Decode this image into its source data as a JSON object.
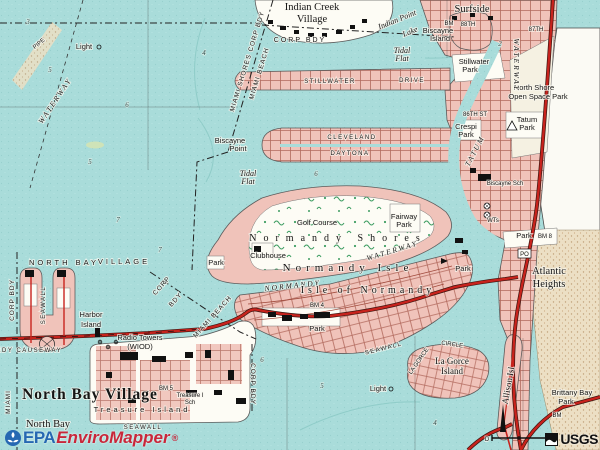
{
  "branding": {
    "epa": "EPA",
    "product": "EnviroMapper",
    "reg": "®",
    "usgs": "USGS"
  },
  "colors": {
    "water": "#a9dcda",
    "urban_pink": "#f0c3ba",
    "street_line": "#b26a5e",
    "major_road_red": "#c8231d",
    "land_white": "#fdfcf5",
    "beach_sand": "#ecdfc4",
    "golf_green": "#3f9e63",
    "epa_blue": "#2668b2",
    "mapper_red": "#c8273a"
  },
  "map": {
    "labels": [
      {
        "t": "Light",
        "x": 84,
        "y": 49,
        "c": "sm",
        "n": "label-light-northwest"
      },
      {
        "t": "WATERWAY",
        "x": 57,
        "y": 102,
        "c": "chan",
        "r": -56,
        "n": "label-intracoastal-waterway"
      },
      {
        "t": "PIPE",
        "x": 40,
        "y": 45,
        "c": "tiny",
        "r": -40,
        "n": "label-pipe"
      },
      {
        "t": "MIAMI SHORES CORP BDY",
        "x": 249,
        "y": 62,
        "c": "bdy",
        "r": -73,
        "n": "label-miami-shores-corp-bdy"
      },
      {
        "t": "MIAMI BEACH",
        "x": 261,
        "y": 74,
        "c": "bdy",
        "r": -73,
        "n": "label-miami-beach-bdy"
      },
      {
        "t": "CORP BDY",
        "x": 300,
        "y": 42,
        "c": "bdy0",
        "n": "label-corp-bdy-top"
      },
      {
        "t": "Indian Creek",
        "x": 312,
        "y": 10,
        "c": "place",
        "n": "label-indian-creek-village"
      },
      {
        "t": "Village",
        "x": 312,
        "y": 22,
        "c": "place",
        "n": "label-indian-creek-village-2"
      },
      {
        "t": "Indian Point",
        "x": 398,
        "y": 22,
        "c": "wat",
        "r": -22,
        "n": "label-indian-point-lake"
      },
      {
        "t": "Lake",
        "x": 411,
        "y": 34,
        "c": "wat",
        "r": -22,
        "n": "label-indian-point-lake-2"
      },
      {
        "t": "Biscayne",
        "x": 438,
        "y": 33,
        "c": "sm",
        "n": "label-biscayne-island"
      },
      {
        "t": "Island",
        "x": 440,
        "y": 41,
        "c": "sm",
        "n": "label-biscayne-island-2"
      },
      {
        "t": "Surfside",
        "x": 472,
        "y": 12,
        "c": "place",
        "n": "label-surfside"
      },
      {
        "t": "88TH",
        "x": 468,
        "y": 26,
        "c": "tiny",
        "n": "label-88th-st"
      },
      {
        "t": "87TH",
        "x": 536,
        "y": 31,
        "c": "tiny",
        "n": "label-87th-st"
      },
      {
        "t": "BM",
        "x": 449,
        "y": 25,
        "c": "tiny",
        "n": "label-bm-surfside"
      },
      {
        "t": "Tidal",
        "x": 402,
        "y": 53,
        "c": "wat",
        "n": "label-tidal-flat-north"
      },
      {
        "t": "Flat",
        "x": 402,
        "y": 61,
        "c": "wat",
        "n": "label-tidal-flat-north-2"
      },
      {
        "t": "STILLWATER",
        "x": 330,
        "y": 83,
        "c": "road",
        "n": "label-stillwater-drive"
      },
      {
        "t": "DRIVE",
        "x": 412,
        "y": 82,
        "c": "road",
        "n": "label-stillwater-drive-2"
      },
      {
        "t": "Stillwater",
        "x": 474,
        "y": 64,
        "c": "sm",
        "n": "label-stillwater-park"
      },
      {
        "t": "Park",
        "x": 470,
        "y": 72,
        "c": "sm",
        "n": "label-stillwater-park-2"
      },
      {
        "t": "North Shore",
        "x": 534,
        "y": 90,
        "c": "sm",
        "n": "label-north-shore-open-space-park"
      },
      {
        "t": "Open Space Park",
        "x": 538,
        "y": 99,
        "c": "sm",
        "n": "label-north-shore-open-space-park-2"
      },
      {
        "t": "WATERWAY",
        "x": 514,
        "y": 65,
        "c": "chan",
        "r": 90,
        "n": "label-tatum-waterway-north"
      },
      {
        "t": "Tatum",
        "x": 527,
        "y": 122,
        "c": "sm",
        "n": "label-tatum-park"
      },
      {
        "t": "Park",
        "x": 527,
        "y": 130,
        "c": "sm",
        "n": "label-tatum-park-2"
      },
      {
        "t": "86TH ST",
        "x": 475,
        "y": 116,
        "c": "tiny",
        "n": "label-86th-st"
      },
      {
        "t": "Crespi",
        "x": 466,
        "y": 129,
        "c": "sm",
        "n": "label-crespi-park"
      },
      {
        "t": "Park",
        "x": 466,
        "y": 137,
        "c": "sm",
        "n": "label-crespi-park-2"
      },
      {
        "t": "CLEVELAND",
        "x": 352,
        "y": 139,
        "c": "road",
        "n": "label-cleveland-road"
      },
      {
        "t": "DAYTONA",
        "x": 350,
        "y": 155,
        "c": "road",
        "n": "label-daytona-road"
      },
      {
        "t": "Biscayne",
        "x": 230,
        "y": 143,
        "c": "sm",
        "n": "label-biscayne-point"
      },
      {
        "t": "Point",
        "x": 238,
        "y": 151,
        "c": "sm",
        "n": "label-biscayne-point-2"
      },
      {
        "t": "Tidal",
        "x": 248,
        "y": 176,
        "c": "wat",
        "n": "label-tidal-flat-south"
      },
      {
        "t": "Flat",
        "x": 248,
        "y": 184,
        "c": "wat",
        "n": "label-tidal-flat-south-2"
      },
      {
        "t": "TATUM",
        "x": 477,
        "y": 152,
        "c": "chan",
        "r": -62,
        "n": "label-tatum-waterway"
      },
      {
        "t": "Biscayne Sch",
        "x": 505,
        "y": 185,
        "c": "tiny",
        "n": "label-biscayne-school"
      },
      {
        "t": "WTs",
        "x": 493,
        "y": 222,
        "c": "tiny",
        "n": "label-water-tanks"
      },
      {
        "t": "Golf Course",
        "x": 317,
        "y": 225,
        "c": "sm",
        "n": "label-golf-course"
      },
      {
        "t": "Normandy Shores",
        "x": 338,
        "y": 241,
        "c": "spread1",
        "n": "label-normandy-shores"
      },
      {
        "t": "Fairway",
        "x": 404,
        "y": 219,
        "c": "sm",
        "n": "label-fairway-park"
      },
      {
        "t": "Park",
        "x": 404,
        "y": 227,
        "c": "sm",
        "n": "label-fairway-park-2"
      },
      {
        "t": "Clubhouse",
        "x": 268,
        "y": 258,
        "c": "sm",
        "n": "label-clubhouse"
      },
      {
        "t": "WATERWAY",
        "x": 393,
        "y": 253,
        "c": "chan",
        "r": -17,
        "n": "label-normandy-waterway"
      },
      {
        "t": "NORMANDY",
        "x": 293,
        "y": 288,
        "c": "chan",
        "r": -6,
        "n": "label-normandy-waterway-2"
      },
      {
        "t": "Normandy Isle",
        "x": 348,
        "y": 271,
        "c": "spread2",
        "n": "label-normandy-isle"
      },
      {
        "t": "Isle of Normandy",
        "x": 368,
        "y": 293,
        "c": "spread3",
        "n": "label-isle-of-normandy"
      },
      {
        "t": "BM 4",
        "x": 317,
        "y": 307,
        "c": "tiny",
        "n": "label-bm-4"
      },
      {
        "t": "Park",
        "x": 317,
        "y": 331,
        "c": "sm",
        "n": "label-normandy-park"
      },
      {
        "t": "SEAWALL",
        "x": 384,
        "y": 350,
        "c": "road",
        "r": -14,
        "n": "label-seawall-normandy"
      },
      {
        "t": "Park",
        "x": 463,
        "y": 271,
        "c": "sm",
        "n": "label-park-71st"
      },
      {
        "t": "Park",
        "x": 524,
        "y": 238,
        "c": "sm",
        "n": "label-park-north-beach"
      },
      {
        "t": "BM 8",
        "x": 545,
        "y": 238,
        "c": "tiny",
        "n": "label-bm-8"
      },
      {
        "t": "PO",
        "x": 524.5,
        "y": 256,
        "c": "tiny",
        "n": "label-post-office"
      },
      {
        "t": "Atlantic",
        "x": 549,
        "y": 274,
        "c": "place",
        "n": "label-atlantic-heights"
      },
      {
        "t": "Heights",
        "x": 549,
        "y": 287,
        "c": "place",
        "n": "label-atlantic-heights-2"
      },
      {
        "t": "NORTH BAY",
        "x": 64,
        "y": 265,
        "c": "spread4",
        "n": "label-north-bay-village-top"
      },
      {
        "t": "VILLAGE",
        "x": 124,
        "y": 264,
        "c": "spread4",
        "n": "label-north-bay-village-top-2"
      },
      {
        "t": "CORP BDY",
        "x": 14,
        "y": 300,
        "c": "bdy",
        "r": -90,
        "n": "label-corp-bdy-west"
      },
      {
        "t": "SEAWALL",
        "x": 45,
        "y": 305,
        "c": "road",
        "r": -90,
        "n": "label-seawall-harbor"
      },
      {
        "t": "Harbor",
        "x": 91,
        "y": 317,
        "c": "sm",
        "n": "label-harbor-island"
      },
      {
        "t": "Island",
        "x": 91,
        "y": 327,
        "c": "sm",
        "n": "label-harbor-island-2"
      },
      {
        "t": "CORP",
        "x": 163,
        "y": 287,
        "c": "bdy",
        "r": -48,
        "n": "label-corp-bdy-nbv"
      },
      {
        "t": "BDY",
        "x": 177,
        "y": 301,
        "c": "bdy",
        "r": -48,
        "n": "label-corp-bdy-nbv-2"
      },
      {
        "t": "MIAMI BEACH",
        "x": 214,
        "y": 318,
        "c": "bdy",
        "r": -48,
        "n": "label-miami-beach-bdy-2"
      },
      {
        "t": "Radio Towers",
        "x": 140,
        "y": 340,
        "c": "sm",
        "n": "label-radio-towers"
      },
      {
        "t": "(WIOD)",
        "x": 140,
        "y": 349,
        "c": "sm",
        "n": "label-wiod"
      },
      {
        "t": "KENNEDY CAUSEWAY",
        "x": 18,
        "y": 352,
        "c": "road",
        "n": "label-causeway"
      },
      {
        "t": "MIAMI",
        "x": 10,
        "y": 402,
        "c": "bdy",
        "r": -90,
        "n": "label-miami-bdy"
      },
      {
        "t": "North Bay Village",
        "x": 90,
        "y": 399,
        "c": "big",
        "n": "label-north-bay-village"
      },
      {
        "t": "BM 5",
        "x": 166,
        "y": 390,
        "c": "tiny",
        "n": "label-bm-5"
      },
      {
        "t": "Treasure I",
        "x": 190,
        "y": 397,
        "c": "tiny",
        "n": "label-treasure-island-school"
      },
      {
        "t": "Sch",
        "x": 190,
        "y": 404,
        "c": "tiny",
        "n": "label-treasure-island-school-2"
      },
      {
        "t": "Treasure Island",
        "x": 142,
        "y": 412,
        "c": "spread4",
        "n": "label-treasure-island"
      },
      {
        "t": "SEAWALL",
        "x": 143,
        "y": 429,
        "c": "road",
        "n": "label-seawall-treasure"
      },
      {
        "t": "North Bay",
        "x": 48,
        "y": 427,
        "c": "place",
        "n": "label-north-bay"
      },
      {
        "t": "CORP BDY",
        "x": 251,
        "y": 384,
        "c": "bdy",
        "r": 90,
        "n": "label-corp-bdy-east-nbv"
      },
      {
        "t": "Park",
        "x": 216,
        "y": 265,
        "c": "sm",
        "n": "label-park-west-lobe"
      },
      {
        "t": "La Gorce",
        "x": 452,
        "y": 364,
        "c": "isl",
        "n": "label-la-gorce-island"
      },
      {
        "t": "Island",
        "x": 452,
        "y": 374,
        "c": "isl",
        "n": "label-la-gorce-island-2"
      },
      {
        "t": "LA GORCE",
        "x": 420,
        "y": 362,
        "c": "tiny",
        "r": -55,
        "n": "label-la-gorce-circle"
      },
      {
        "t": "CIRCLE",
        "x": 452,
        "y": 346,
        "c": "tiny",
        "r": 8,
        "n": "label-la-gorce-circle-2"
      },
      {
        "t": "Allison Isl",
        "x": 511,
        "y": 386,
        "c": "isl",
        "r": -80,
        "n": "label-allison-island"
      },
      {
        "t": "Light",
        "x": 378,
        "y": 391,
        "c": "sm",
        "n": "label-light-south"
      },
      {
        "t": "Brittany Bay",
        "x": 572,
        "y": 395,
        "c": "sm",
        "n": "label-brittany-bay-park"
      },
      {
        "t": "Park",
        "x": 566,
        "y": 404,
        "c": "sm",
        "n": "label-brittany-bay-park-2"
      },
      {
        "t": "BM",
        "x": 557,
        "y": 417,
        "c": "tiny",
        "n": "label-bm-brittany"
      },
      {
        "t": "D",
        "x": 487,
        "y": 441,
        "c": "tiny",
        "n": "label-scale-d"
      },
      {
        "t": "0",
        "x": 550,
        "y": 441,
        "c": "tiny",
        "n": "label-scale-0"
      }
    ],
    "depths": [
      {
        "v": "3",
        "x": 28,
        "y": 24
      },
      {
        "v": "4",
        "x": 204,
        "y": 55
      },
      {
        "v": "5",
        "x": 50,
        "y": 72
      },
      {
        "v": "6",
        "x": 127,
        "y": 107
      },
      {
        "v": "5",
        "x": 90,
        "y": 164
      },
      {
        "v": "7",
        "x": 118,
        "y": 222
      },
      {
        "v": "6",
        "x": 316,
        "y": 176
      },
      {
        "v": "2",
        "x": 500,
        "y": 46
      },
      {
        "v": "5",
        "x": 322,
        "y": 388
      },
      {
        "v": "6",
        "x": 262,
        "y": 362
      },
      {
        "v": "4",
        "x": 435,
        "y": 425
      },
      {
        "v": "7",
        "x": 160,
        "y": 252
      }
    ]
  }
}
